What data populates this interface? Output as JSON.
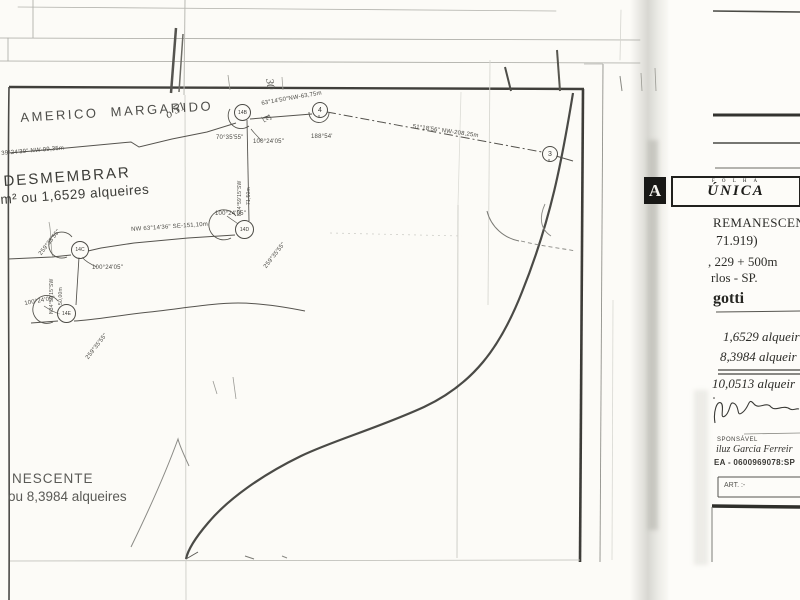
{
  "colors": {
    "paper": "#fcfbf7",
    "ink": "#3f3e3a",
    "frame": "#403f3b",
    "stamp_bg": "#181816"
  },
  "map": {
    "owner_label": "AMERICO  MARGARIDO",
    "parcel_a_line1": "DESMEMBRAR",
    "parcel_a_line2": "m² ou 1,6529 alqueires",
    "parcel_b_line1": "NESCENTE",
    "parcel_b_line2": "ou 8,3984 alqueires",
    "handwriting": [
      "o 51",
      "30",
      "E"
    ],
    "markers": [
      "3",
      "4",
      "14B",
      "14D",
      "14C",
      "14E"
    ],
    "bearing_labels": [
      "39°24'39\" NW-99,35m",
      "63°14'50\"NW-63,75m",
      "70°35'55\"",
      "100°24'05\"",
      "188°54'",
      "51°18'56\" NW-208,25m",
      "N34°59'15\"SW",
      "71,50m",
      "NW 63°14'36\" SE-151,10m",
      "100°24'05\"",
      "259°35'55\"",
      "259°35'55\"",
      "100°24'05\"",
      "N34°59'15\"SW",
      "50,00m",
      "100°24'05\"",
      "259°35'55\""
    ]
  },
  "title_block": {
    "stamp_letter": "A",
    "folha_label": "F O L H A",
    "folha_value": "ÚNICA",
    "line_remanescente": "REMANESCENTE",
    "line_number": "71.919)",
    "line_km": ", 229 + 500m",
    "line_city": "rlos - SP.",
    "line_name": "gotti",
    "area_1": "1,6529 alqueir",
    "area_2": "8,3984 alqueir",
    "area_total": "10,0513 alqueir",
    "resp_label": "SPONSÁVEL",
    "resp_name": "iluz Garcia Ferreir",
    "resp_reg": "EA - 0600969078:SP",
    "art_label": "ART. :-"
  }
}
